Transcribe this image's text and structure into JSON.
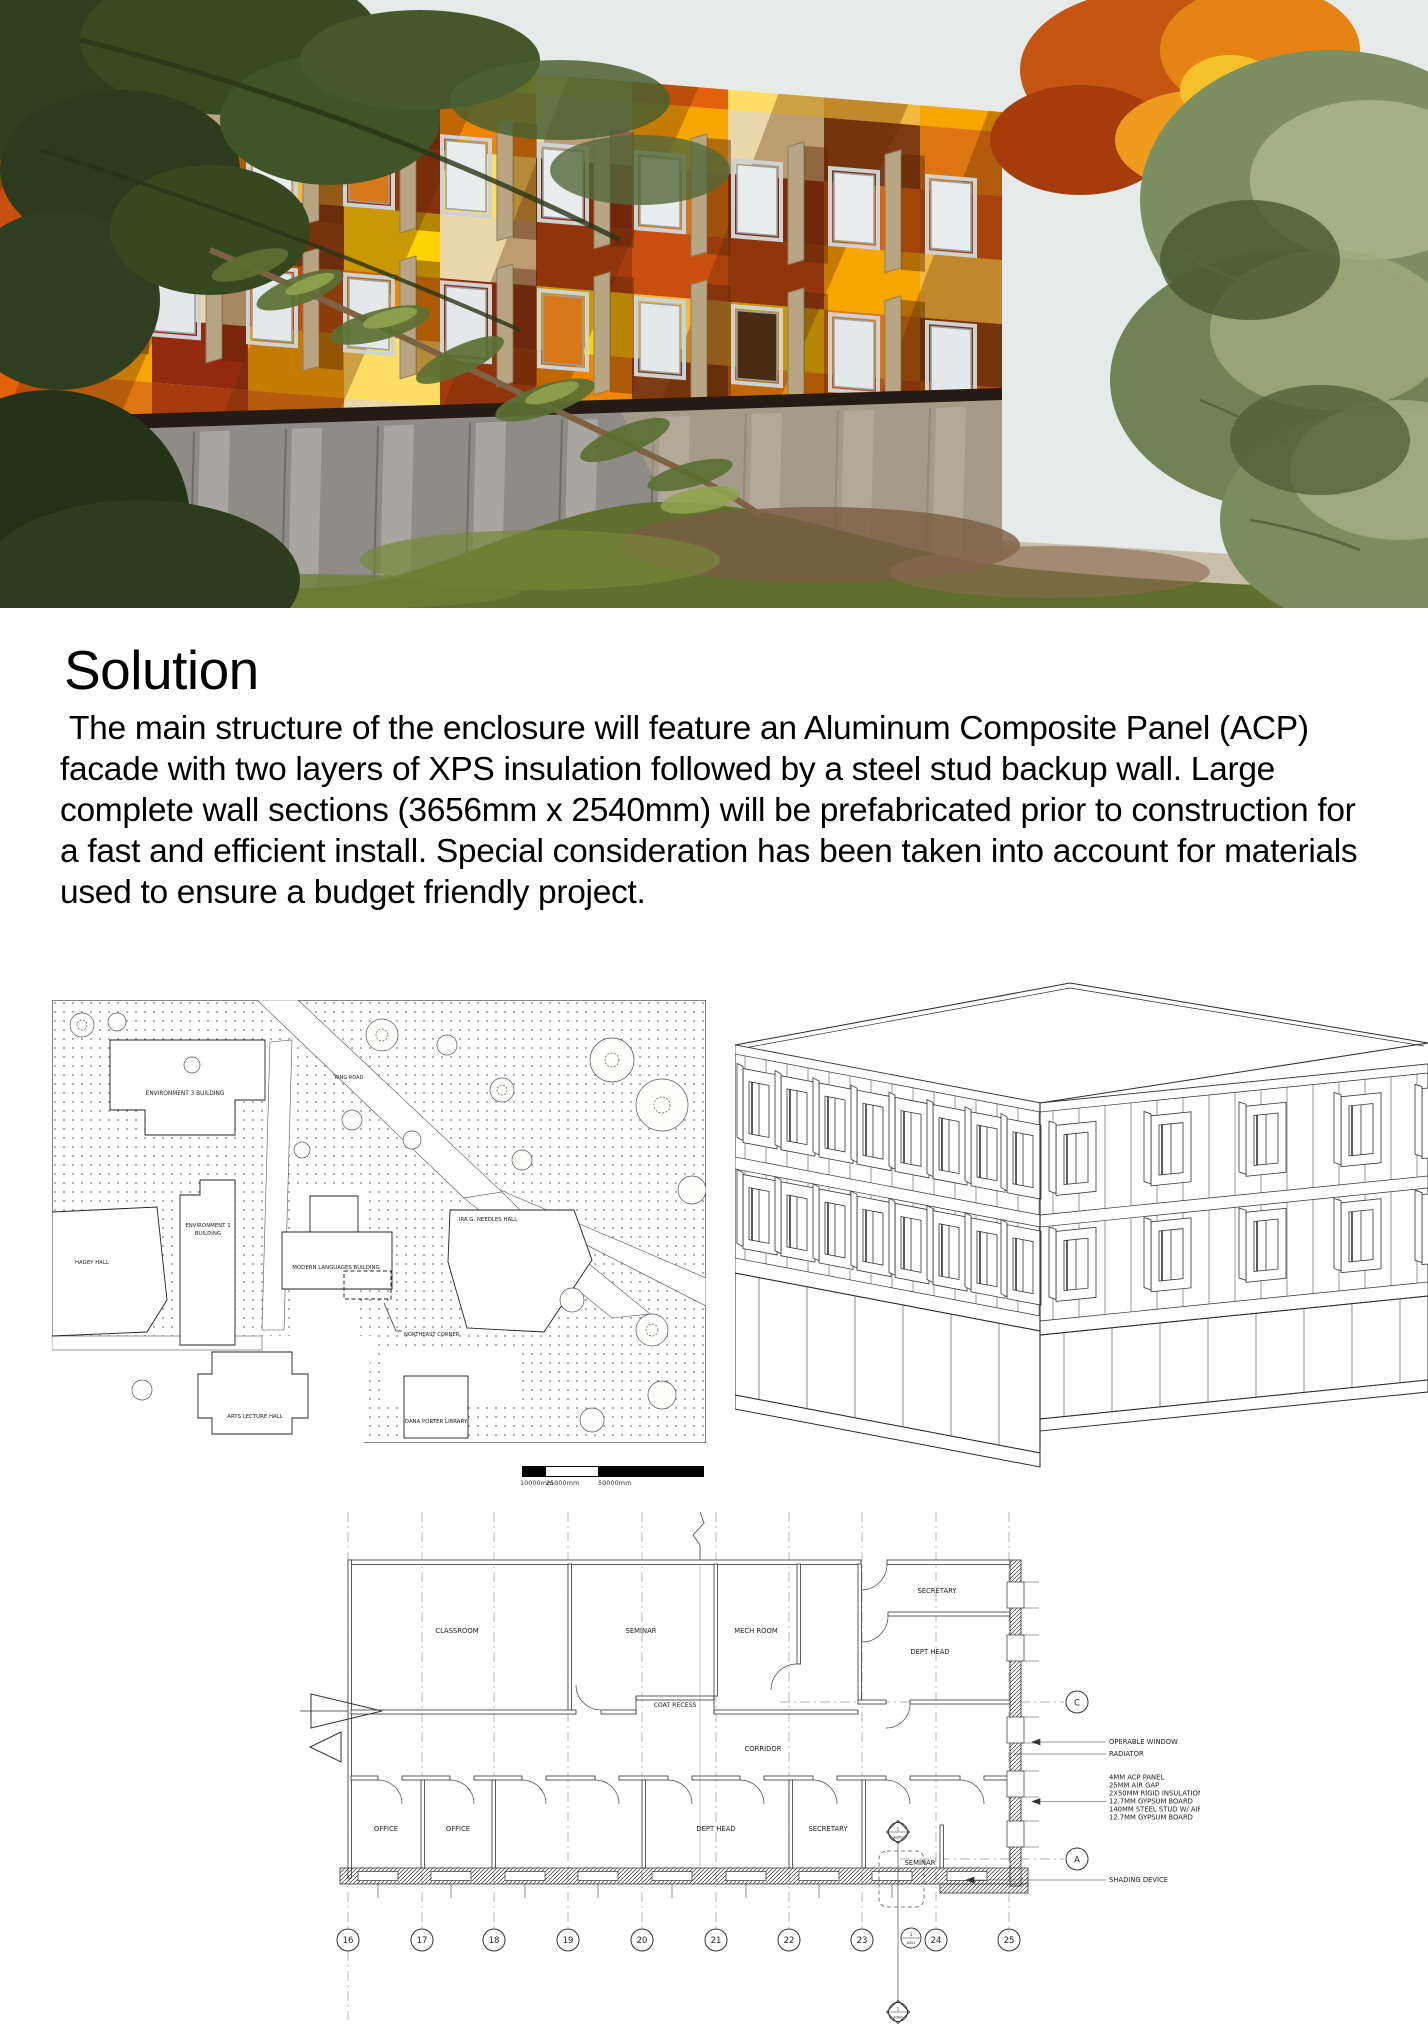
{
  "heading": "Solution",
  "paragraph": " The main structure of the enclosure will feature an Aluminum Composite Panel (ACP) facade with two layers of XPS insulation followed by a steel stud backup wall. Large complete wall sections (3656mm x 2540mm) will be prefabricated prior to construction for a fast and efficient install. Special consideration has been taken into account for materials used to ensure a budget friendly project.",
  "hero": {
    "description": "Rendering of building with orange, yellow and red ACP panel facade behind conifer branches and autumn foliage",
    "palette": [
      "#ee8600",
      "#f7a600",
      "#ffd300",
      "#e2610b",
      "#a63b10",
      "#7e3a12",
      "#93290f",
      "#f3b93e",
      "#ead8ac",
      "#c94f0e",
      "#ffdf63",
      "#dc7610"
    ],
    "sky": "#e6eae9",
    "base_concrete": "#8e8c85",
    "grass": "#5e6f2e"
  },
  "site_plan": {
    "labels": {
      "env3": "ENVIRONMENT 3 BUILDING",
      "ring_road": "RING ROAD",
      "env1_line1": "ENVIRONMENT 1",
      "env1_line2": "BUILDING",
      "hagey": "HAGEY HALL",
      "modern": "MODERN LANGUAGES BUILDING",
      "ira": "IRA G. NEEDLES HALL",
      "northeast": "NORTHEAST CORNER",
      "arts": "ARTS LECTURE HALL",
      "dana": "DANA PORTER LIBRARY"
    },
    "scale_labels": [
      "10000mm",
      "25000mm",
      "50000mm"
    ]
  },
  "floor_plan": {
    "rooms_top": [
      "CLASSROOM",
      "SEMINAR",
      "MECH ROOM"
    ],
    "room_secretary_top": "SECRETARY",
    "room_depthead_top": "DEPT HEAD",
    "coat_recess": "COAT RECESS",
    "corridor": "CORRIDOR",
    "rooms_bottom": [
      "OFFICE",
      "OFFICE",
      "DEPT HEAD",
      "SECRETARY",
      "SEMINAR"
    ],
    "grid_bubbles": [
      "16",
      "17",
      "18",
      "19",
      "20",
      "21",
      "22",
      "23",
      "24",
      "25"
    ],
    "row_bubble_c": "C",
    "row_bubble_a": "A",
    "callout_window": "OPERABLE WINDOW",
    "callout_radiator": "RADIATOR",
    "wall_assembly": [
      "4MM ACP PANEL",
      "25MM AIR GAP",
      "2X50MM RIGID INSULATION",
      "12.7MM GYPSUM BOARD",
      "140MM STEEL STUD W/ AIR",
      "12.7MM GYPSUM BOARD"
    ],
    "callout_shading": "SHADING DEVICE",
    "section_number": "1",
    "section_sheet": "A300",
    "detail_sheet": "A301"
  }
}
